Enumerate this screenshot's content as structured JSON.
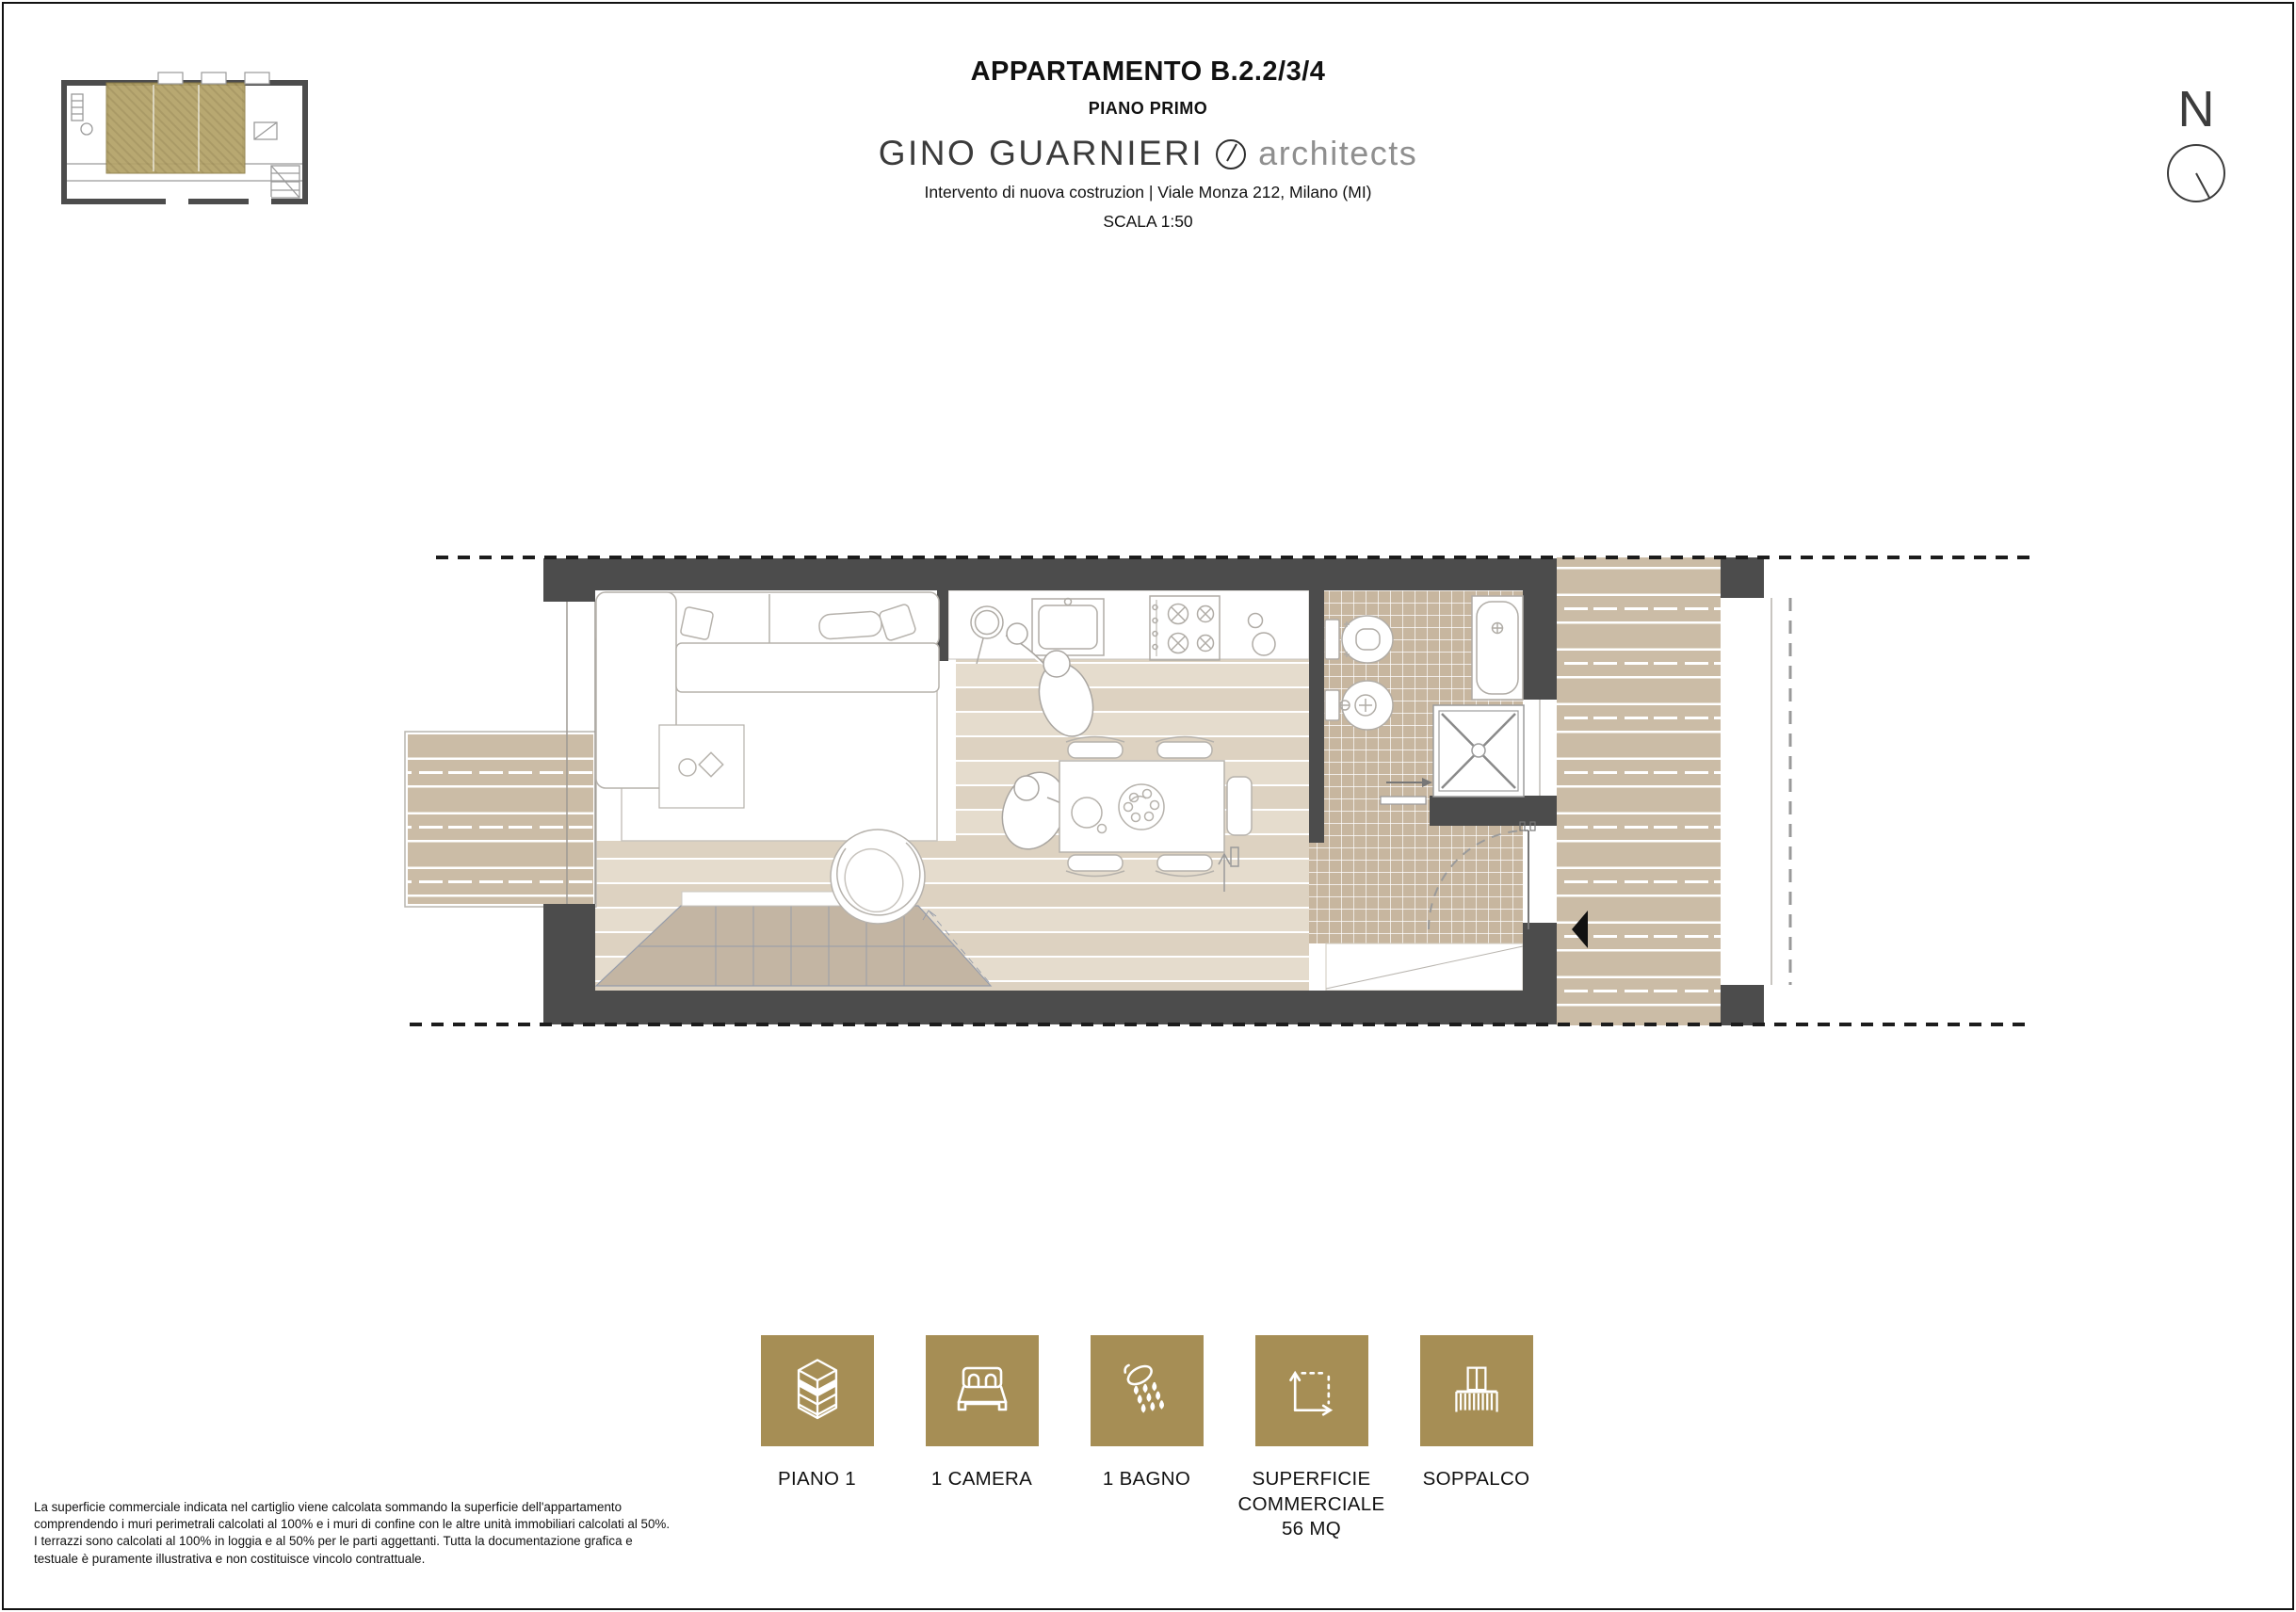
{
  "header": {
    "title": "APPARTAMENTO B.2.2/3/4",
    "subtitle": "PIANO PRIMO",
    "logo_name": "GINO GUARNIERI",
    "logo_suffix": "architects",
    "project_line": "Intervento di nuova costruzion | Viale Monza 212, Milano (MI)",
    "scale_line": "SCALA 1:50"
  },
  "north_indicator": {
    "label": "N"
  },
  "key_plan": {
    "highlight_color": "#b2a166",
    "wall_color": "#4c4c4c"
  },
  "plan": {
    "wall_color": "#4c4c4c",
    "wood_interior_color": "#ddd2c1",
    "wood_exterior_color": "#cbbca6",
    "tile_color": "#c7b69f",
    "stair_color": "#c3b5a3"
  },
  "badges": {
    "accent_color": "#a68e55",
    "items": [
      {
        "icon": "floor-stack-icon",
        "label": "PIANO 1"
      },
      {
        "icon": "bed-icon",
        "label": "1 CAMERA"
      },
      {
        "icon": "shower-icon",
        "label": "1 BAGNO"
      },
      {
        "icon": "area-dimension-icon",
        "label": "SUPERFICIE\nCOMMERCIALE\n56 MQ"
      },
      {
        "icon": "balcony-icon",
        "label": "SOPPALCO"
      }
    ]
  },
  "disclaimer": {
    "lines": [
      "La superficie commerciale indicata nel cartiglio viene calcolata sommando la superficie dell'appartamento",
      "comprendendo i muri perimetrali calcolati al 100% e i muri di confine con le altre unità immobiliari calcolati al 50%.",
      "I terrazzi sono calcolati al 100% in loggia e al 50% per le parti aggettanti. Tutta la documentazione grafica e",
      "testuale è puramente illustrativa e non costituisce vincolo contrattuale."
    ]
  }
}
